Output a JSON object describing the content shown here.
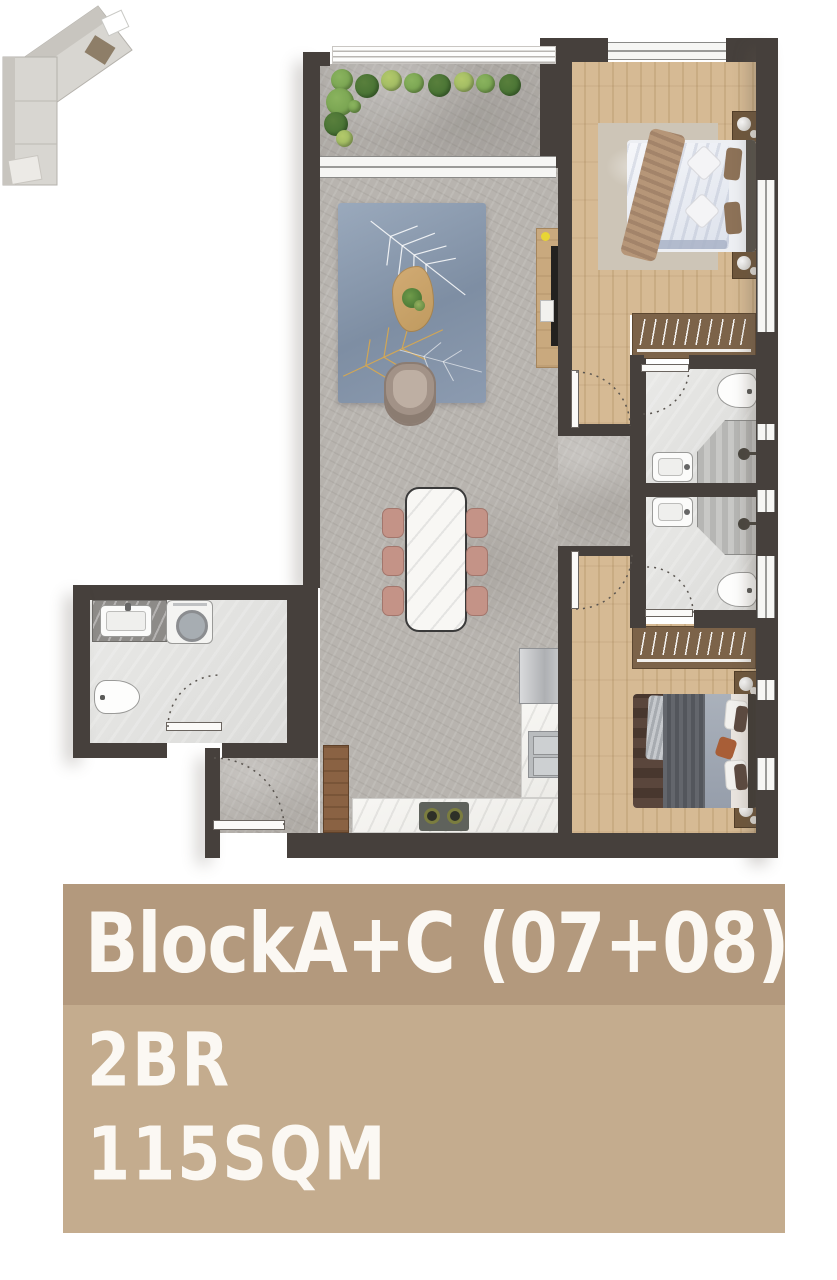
{
  "panel": {
    "title": "BlockA+C (07+08)",
    "line1": "2BR",
    "line2": "115SQM",
    "header_bg": "#b3997d",
    "body_bg": "#c4ac8e",
    "text_color": "#fbf8f3"
  },
  "plan": {
    "colors": {
      "wall": "#46403c",
      "stone": "#b8b4af",
      "wood": "#d6ba94",
      "wood2": "#c9ac83",
      "green1": "#6f9b4a",
      "green2": "#3e6c2f",
      "green3": "#93b05e"
    },
    "rooms": [
      {
        "id": "balcony"
      },
      {
        "id": "living-room"
      },
      {
        "id": "dining-area"
      },
      {
        "id": "kitchen"
      },
      {
        "id": "entry-hall"
      },
      {
        "id": "bedroom-1"
      },
      {
        "id": "bathroom-1"
      },
      {
        "id": "bathroom-2"
      },
      {
        "id": "bedroom-2"
      },
      {
        "id": "guest-wc"
      }
    ],
    "fixtures": [
      "sofa",
      "area-rug",
      "coffee-table",
      "armchair",
      "tv-unit",
      "dining-table",
      "dining-chairs",
      "kitchen-counter",
      "cooktop",
      "kitchen-sink",
      "refrigerator",
      "pantry-cabinet",
      "double-bed",
      "nightstand",
      "wardrobe",
      "toilet",
      "washbasin",
      "shower",
      "washing-machine",
      "balcony-plants",
      "doors",
      "windows"
    ]
  }
}
